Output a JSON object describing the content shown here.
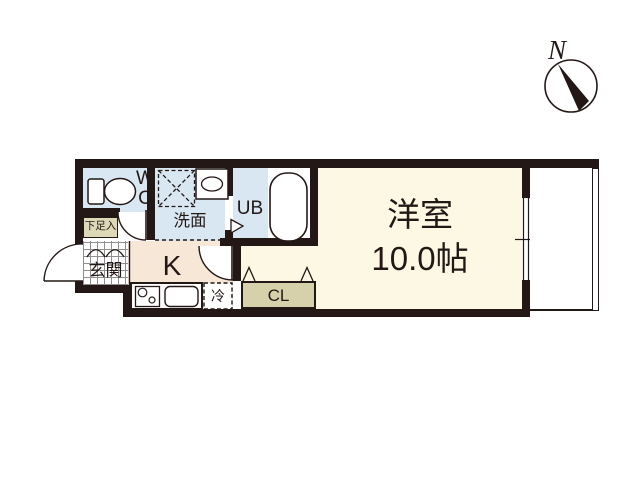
{
  "compass": {
    "north_label": "N"
  },
  "rooms": {
    "wc": {
      "label_line1": "W",
      "label_line2": "C"
    },
    "washroom": {
      "label": "洗面"
    },
    "bath": {
      "label": "UB"
    },
    "entrance": {
      "label": "玄関"
    },
    "shoe_storage": {
      "label": "下足入"
    },
    "kitchen": {
      "label": "K"
    },
    "refrigerator": {
      "label": "冷"
    },
    "closet": {
      "label": "CL"
    },
    "main_room": {
      "name": "洋室",
      "size": "10.0帖"
    }
  },
  "colors": {
    "wall": "#231815",
    "wet_rooms": "#d9e7f3",
    "main_room": "#fdf8e4",
    "kitchen": "#f7e7d6",
    "closet": "#d6d1ab",
    "shoe_storage": "#ddd8b6"
  }
}
